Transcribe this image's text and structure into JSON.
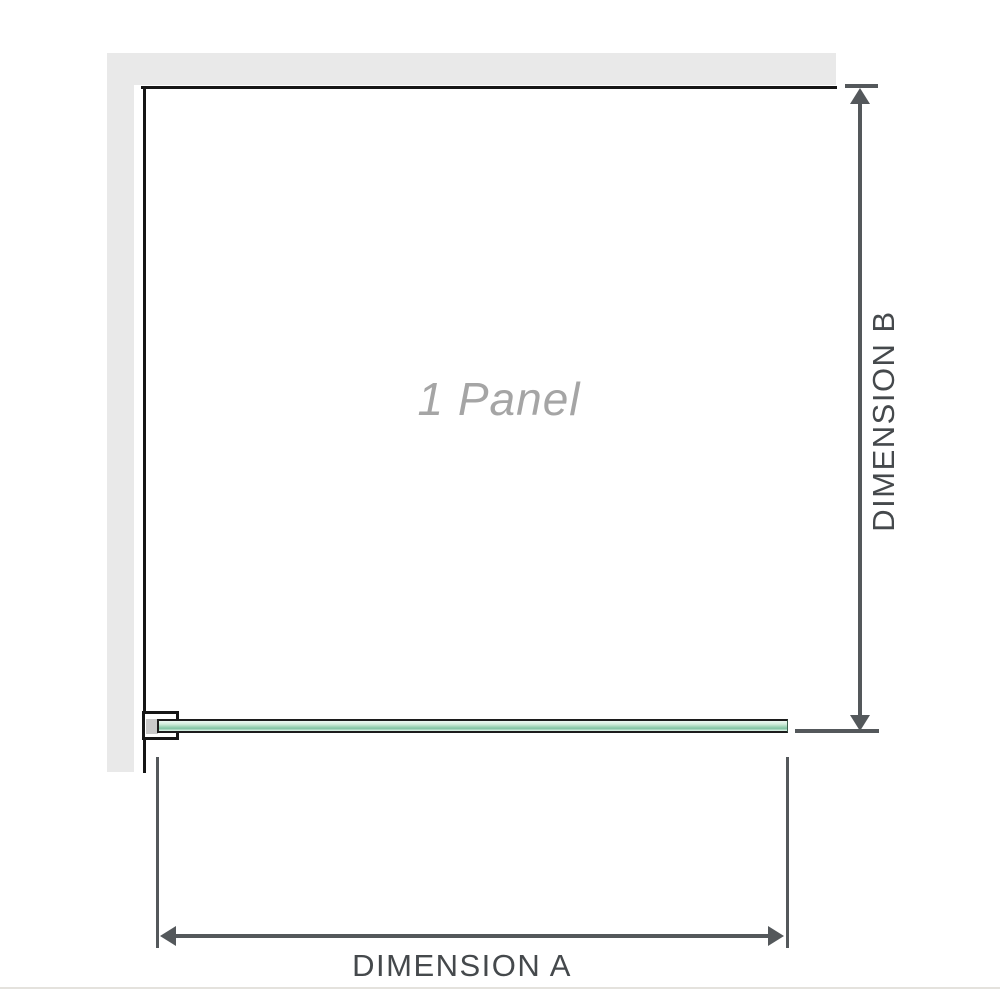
{
  "diagram": {
    "panel_label": "1 Panel",
    "dimension_a_label": "DIMENSION A",
    "dimension_b_label": "DIMENSION B"
  },
  "icons": {
    "dimension_b": [
      "arrow-up-icon",
      "arrow-down-icon"
    ],
    "dimension_a": [
      "arrow-left-icon",
      "arrow-right-icon"
    ]
  },
  "colors": {
    "background": "#ffffff",
    "wall_fill": "#e9e9e9",
    "panel_outline": "#161616",
    "dimension_line": "#54585b",
    "dimension_label_text": "#45494c",
    "panel_label_text": "#a5a5a5",
    "glass_green_main": "#9ad2b4",
    "glass_green_dark": "#7fc2a1",
    "glass_green_light": "#d3eedd",
    "clamp_spacer": "#c9c9c9",
    "bottom_divider": "#e4e2dd"
  }
}
